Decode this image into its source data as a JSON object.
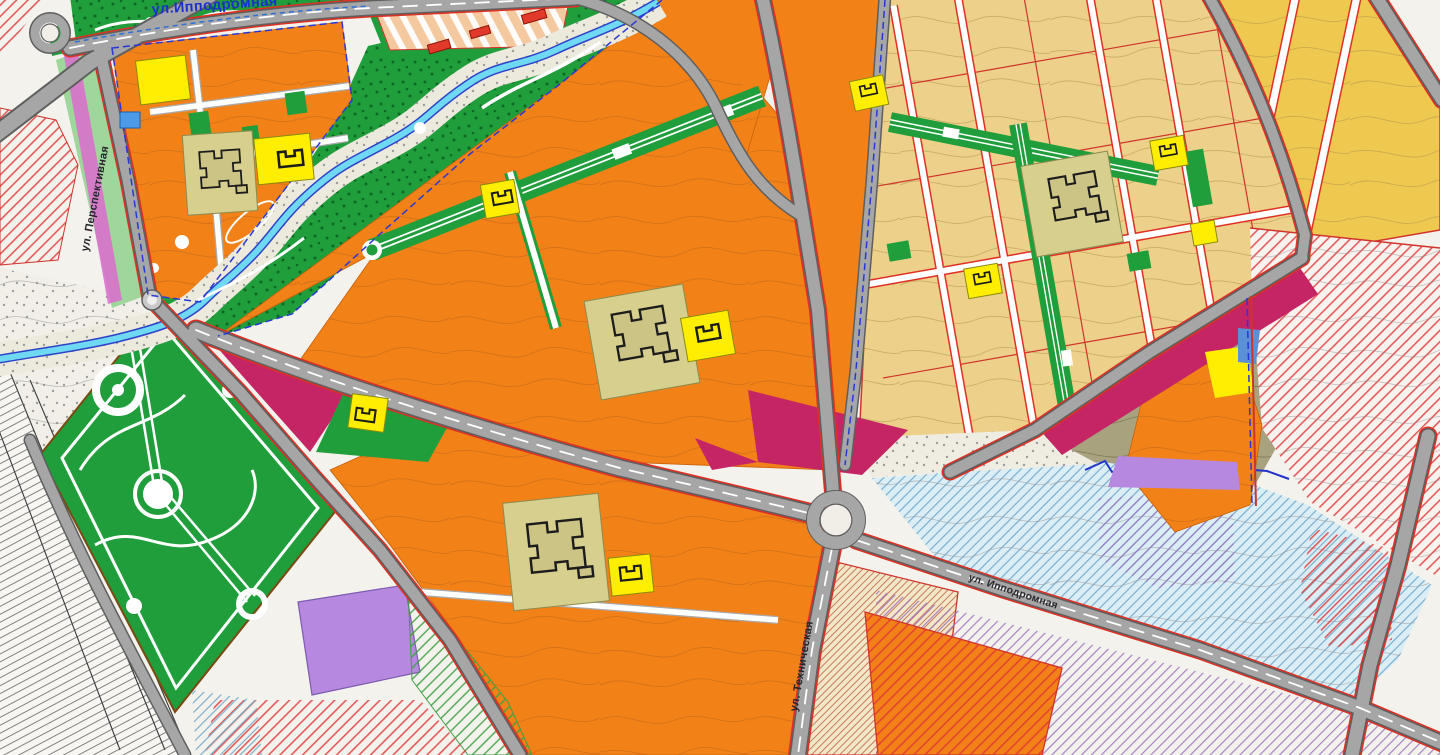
{
  "map": {
    "kind": "urban-master-plan",
    "street_labels": {
      "top": "ул.Ипподромная",
      "left": "ул. Перспективная",
      "bottom_center": "ул. Техническая",
      "bottom_right": "ул. Ипподромная"
    },
    "colors": {
      "paper": "#f4f2ec",
      "midrise_residential": "#f28118",
      "individual_residential": "#edd089",
      "individual_residential_gold": "#efc850",
      "park_green": "#1f9e3b",
      "school_site": "#d6cf8d",
      "kindergarten_site": "#ffee00",
      "public_magenta": "#c52565",
      "lavender_zone": "#b788df",
      "river_water": "#6fd8f2",
      "river_outline": "#2e43c8",
      "floodplain": "#ece9dd",
      "ravine_olive": "#a8a37e",
      "hippodrome_peach": "#f5c9a0",
      "cream_hatch_zone": "#f2e8c8",
      "lightblue_zone": "#dceef5",
      "road_fill": "#a6a6a6",
      "road_casing": "#5f5f5f",
      "road_edge_red": "#e03024",
      "boundary_blue": "#2838d6",
      "parcel_red": "#d0342c"
    }
  }
}
